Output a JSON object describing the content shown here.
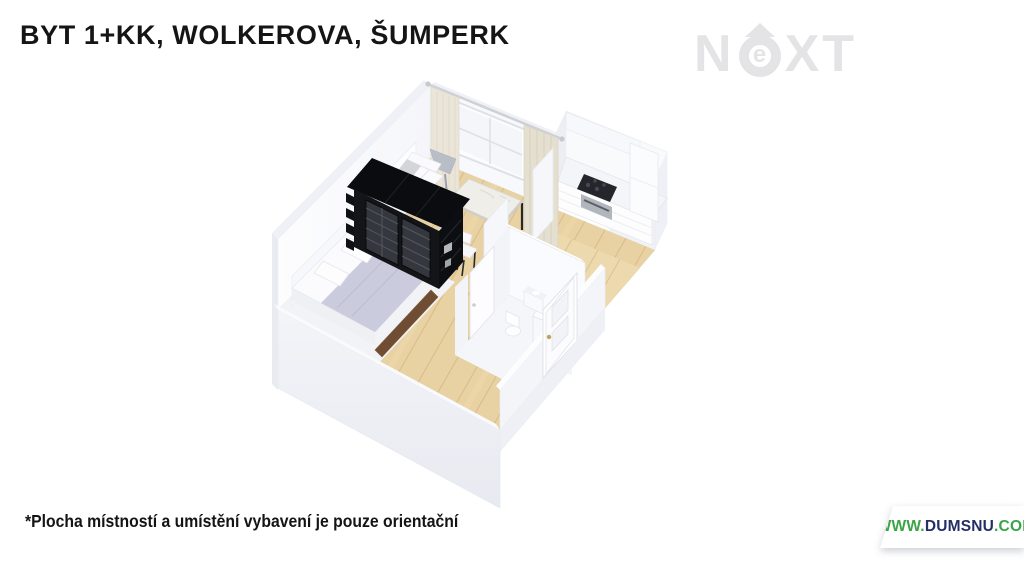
{
  "header": {
    "title": "BYT 1+KK, WOLKEROVA, ŠUMPERK"
  },
  "watermark": {
    "n": "N",
    "e": "e",
    "xt": "XT",
    "color": "#e4e4e6"
  },
  "floorplan": {
    "alt": "3D cutaway floor plan of a 1+KK apartment",
    "items": [
      "curtains",
      "window",
      "floor lamp",
      "sofa",
      "dining table with two chairs",
      "kitchen counter with cooktop and oven",
      "tall kitchen cabinet",
      "black wardrobe shelf unit",
      "bed with pillows and blanket",
      "hallway",
      "bathroom with shower, toilet and washbasin",
      "entry door",
      "wooden floor"
    ],
    "colors": {
      "wall_white": "#f8f9fc",
      "wall_shadow": "#eceef3",
      "wall_exterior": "#eef0f5",
      "floor_wood": "#e8d1a3",
      "plank_line": "#d8ba85",
      "hall_wood": "#edd9ae",
      "nook_floor": "#f2f3f6",
      "wardrobe_black": "#141519",
      "curtain_cream": "#eae5d8",
      "bed_blanket": "#cacbdc",
      "marble_table": "#efeee9",
      "cooktop": "#24262b",
      "bed_frame_brown": "#6f4d33"
    }
  },
  "footer": {
    "disclaimer": "*Plocha místností a umístění vybavení je pouze orientační",
    "website": {
      "www": "WWW.",
      "domain": "DUMSNU",
      "tld": ".COM",
      "green": "#3ba447",
      "navy": "#252f66"
    }
  }
}
